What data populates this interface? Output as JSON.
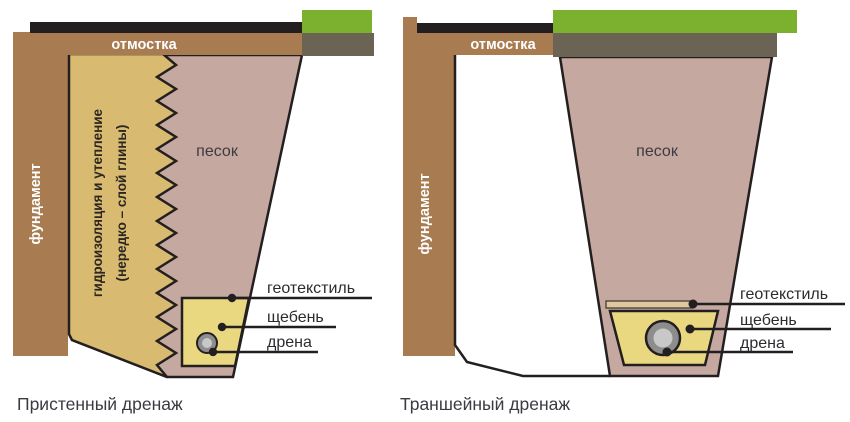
{
  "left": {
    "caption": "Пристенный дренаж",
    "foundation": "фундамент",
    "blind_area": "отмостка",
    "waterproofing_line1": "гидроизоляция и утепление",
    "waterproofing_line2": "(нередко – слой глины)",
    "sand": "песок",
    "labels": {
      "geotextile": "геотекстиль",
      "gravel": "щебень",
      "drain": "дрена"
    }
  },
  "right": {
    "caption": "Траншейный дренаж",
    "foundation": "фундамент",
    "blind_area": "отмостка",
    "sand": "песок",
    "labels": {
      "geotextile": "геотекстиль",
      "gravel": "щебень",
      "drain": "дрена"
    }
  },
  "colors": {
    "foundation_brown": "#a87c50",
    "membrane_black": "#231f20",
    "grass_green": "#7cb12f",
    "topsoil_olive": "#6b6353",
    "insulation_tan": "#d8ba70",
    "sand_pink": "#c5a8a0",
    "gravel_yellow": "#ead881",
    "geotextile_cream": "#dfc7a0",
    "pipe_ring_gray": "#8d8d8d",
    "pipe_inner_gray": "#c8c8c8",
    "dot_black": "#231f20"
  }
}
